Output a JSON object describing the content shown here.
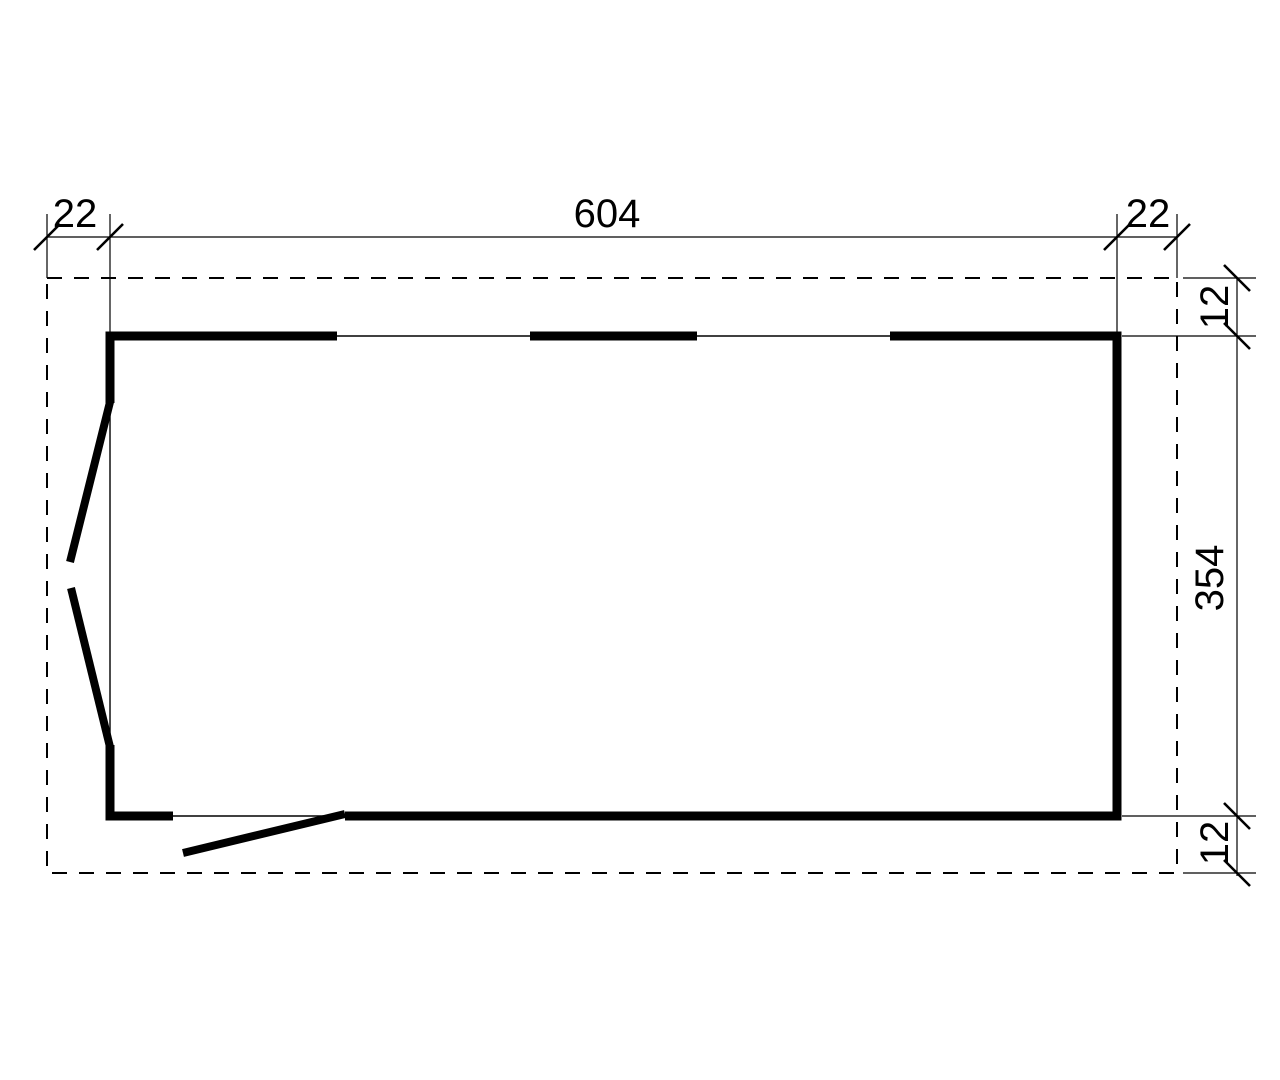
{
  "page": {
    "background_color": "#ffffff"
  },
  "drawing": {
    "type": "floor-plan",
    "line_color": "#000000",
    "dims": {
      "top_left_offset": "22",
      "top_width": "604",
      "top_right_offset": "22",
      "right_top_offset": "12",
      "right_height": "354",
      "right_bottom_offset": "12"
    }
  }
}
